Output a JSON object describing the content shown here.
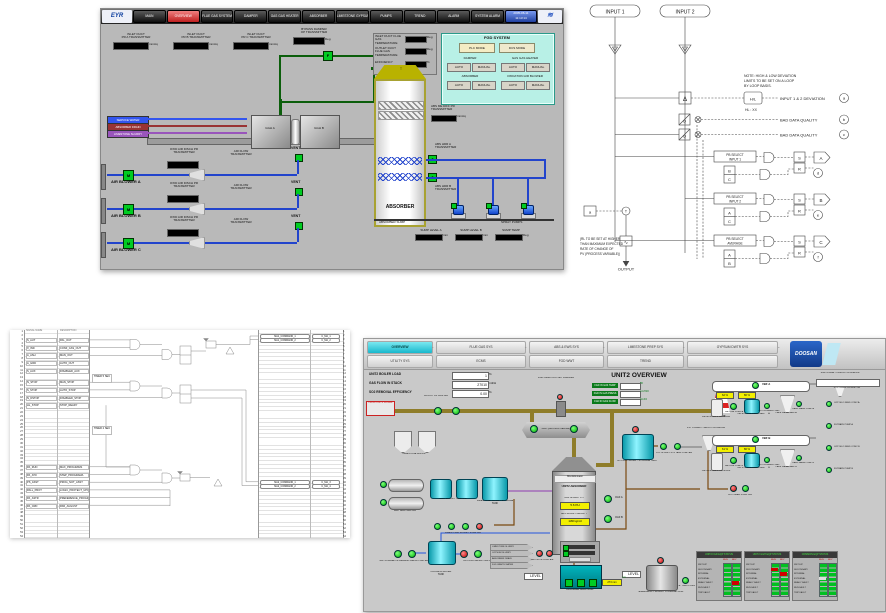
{
  "colors": {
    "active_tab": "#18b8cc",
    "pump_on": "#00b400",
    "pump_off": "#c00000",
    "value_yellow": "#f2ef00",
    "panel_cyan": "#b8f0e6",
    "pipe_blue": "#2244cc",
    "pipe_green": "#0b5e0b",
    "duct_olive": "#8f7d2a"
  },
  "panelA": {
    "nav": {
      "logo": "EYR",
      "buttons": [
        "MAIN",
        "OVERVIEW",
        "FLUE GAS SYSTEM",
        "DAMPER",
        "GAS GAS HEATER",
        "ABSORBER",
        "LIMESTONE GYPSUM",
        "PUMPS",
        "TREND",
        "ALARM",
        "SYSTEM ALARM"
      ],
      "clock1": "2005-06-11",
      "clock2": "11:13:14",
      "brand": "≋"
    },
    "inlet_metrics": [
      {
        "l1": "INLET DUCT",
        "l2": "PR A TRANSMITTER",
        "unit": "mmAq"
      },
      {
        "l1": "INLET DUCT",
        "l2": "PR B TRANSMITTER",
        "unit": "mmAq"
      },
      {
        "l1": "INLET DUCT",
        "l2": "PR C TRANSMITTER",
        "unit": "mmAq"
      }
    ],
    "bypass": {
      "l1": "BYPASS DAMPER",
      "l2": "OP TRANSMITTER",
      "unit": "Deg",
      "flag": "F"
    },
    "right_metrics": [
      {
        "l1": "INLET DUCT FLUE GAS",
        "l2": "TEMPERATURE",
        "unit": "Deg"
      },
      {
        "l1": "OUTLET DUCT FLUE GAS",
        "l2": "TEMPERATURE",
        "unit": "Deg"
      },
      {
        "l1": "EFFICIENCY",
        "l2": "",
        "unit": "%"
      }
    ],
    "fgd_panel": {
      "title": "FGD SYSTEM",
      "plc": "PLC MODE",
      "dcs": "DCS MODE",
      "groups": [
        {
          "t": "DAMPER",
          "a": "AUTO",
          "m": "MANUAL"
        },
        {
          "t": "GAS GAS HEATER",
          "a": "AUTO",
          "m": "MANUAL"
        },
        {
          "t": "ABSORBER",
          "a": "AUTO",
          "m": "MANUAL"
        },
        {
          "t": "OXIDATION AIR BLOWER",
          "a": "AUTO",
          "m": "MANUAL"
        }
      ]
    },
    "tags": [
      "SERVICE WATER",
      "ABSORBER DRAIN",
      "LIMESTONE SLURRY"
    ],
    "ggh": [
      "GGH A",
      "GGH B"
    ],
    "absorber": {
      "label": "ABSORBER",
      "arrow": "↑",
      "me_l1": "ABS ME DIFF PR",
      "me_l2": "TRANSMITTER",
      "me_unit": "mmAq",
      "hdr_a": "ABS HDR A TRANSMITTER",
      "hdr_b": "ABS HDR B TRANSMITTER",
      "valve": "X"
    },
    "blowers": [
      {
        "name": "AIR BLOWER A",
        "tx1": "OXID AIR DISCH PR",
        "tx2": "TRANSMITTER",
        "rx1": "AIR FLOW",
        "rx2": "TRANSMITTER",
        "vent": "VENT",
        "m": "M"
      },
      {
        "name": "AIR BLOWER B",
        "tx1": "OXID AIR DISCH PR",
        "tx2": "TRANSMITTER",
        "rx1": "AIR FLOW",
        "rx2": "TRANSMITTER",
        "vent": "VENT",
        "m": "M"
      },
      {
        "name": "AIR BLOWER C",
        "tx1": "OXID AIR DISCH PR",
        "tx2": "TRANSMITTER",
        "rx1": "AIR FLOW",
        "rx2": "TRANSMITTER",
        "vent": "VENT",
        "m": "M"
      }
    ],
    "sump": {
      "left": "ABSORBER SUMP",
      "right": "SPRAY PUMPS",
      "metrics": [
        {
          "l1": "SUMP LEVEL A",
          "unit": "mm"
        },
        {
          "l1": "SUMP LEVEL B",
          "unit": "mm"
        },
        {
          "l1": "SUMP TEMP",
          "unit": "Deg"
        }
      ]
    }
  },
  "panelB": {
    "inputs": [
      "INPUT 1",
      "INPUT 2"
    ],
    "tri": "T",
    "delta": "Δ",
    "hl_box": "H/L",
    "note": [
      "NOTE: HIGH & LOW DEVIATION",
      "LIMITS TO BE SET ON A LOOP",
      "BY LOOP BASIS."
    ],
    "hl": "HL : XX",
    "dev_label": "INPUT 1 & 2 DEVIATION",
    "dev_circle": "a",
    "qual": "Q",
    "badq1": "BAD DATA QUALITY",
    "badq1_c": "b",
    "badq2": "BAD DATA QUALITY",
    "badq2_c": "c",
    "sel": [
      {
        "b1": "PB SELECT",
        "b2": "INPUT 1",
        "p1": "B",
        "p2": "C",
        "s": "S",
        "r": "R",
        "out": "A",
        "fb": "d"
      },
      {
        "b1": "PB SELECT",
        "b2": "INPUT 2",
        "p1": "A",
        "p2": "C",
        "s": "S",
        "r": "R",
        "out": "B",
        "fb": "e"
      },
      {
        "b1": "PB SELECT",
        "b2": "AVERAGE",
        "p1": "A",
        "p2": "B",
        "s": "S",
        "r": "R",
        "out": "C",
        "fb": "f"
      }
    ],
    "note2": [
      "(RL TO BE SET AT HIGHER",
      "THAN MAXIMUM EXPECTED",
      "RATE OF CHANGE OF",
      "PV (PROCESS VARIABLE))"
    ],
    "in_box": "a",
    "transfer": "T",
    "rate": "∿",
    "output": "OUTPUT"
  },
  "panelC": {
    "headers": {
      "sig": "SIGNAL NAME",
      "desc": "DESCRIPTION"
    },
    "left_nums": "1\n2\n3\n4\n5\n6\n7\n8\n9\n10\n11\n12\n13\n14\n15\n16\n17\n18\n19\n20\n21\n22\n23\n24\n25\n26\n27\n28\n29\n30\n31\n32\n33\n34\n35\n36\n37\n38\n39\n40\n41\n42\n43\n44\n45\n46\n47\n48\n49\n50\n51\n52\n53\n54",
    "right_nums": "1\n2\n3\n4\n5\n6\n7\n8\n9\n10\n11\n12\n13\n14\n15\n16\n17\n18\n19\n20\n21\n22\n23\n24\n25\n26\n27\n28\n29\n30\n31\n32\n33\n34\n35\n36\n37\n38\n39\n40\n41\n42\n43\n44\n45\n46\n47\n48\n49\n50\n51\n52\n53\n54",
    "rows": [
      {
        "sig": "S_AUT",
        "desc": "PAL_OUT"
      },
      {
        "sig": "X_IND",
        "desc": "CONF_CAS_OUT"
      },
      {
        "sig": "A_ASH",
        "desc": "MAN_OUT"
      },
      {
        "sig": "A_GRD",
        "desc": "AUTO_OUT"
      },
      {
        "sig": "S_AUX",
        "desc": "DISABLED_AUX"
      },
      {
        "sig": "N_STOP",
        "desc": "MAN_STOP"
      },
      {
        "sig": "S_STOP",
        "desc": "AUTO_STOP"
      },
      {
        "sig": "N_DSTOP",
        "desc": "DISABLED_STOP"
      },
      {
        "sig": "HL_STOP",
        "desc": "STOP_READY"
      },
      {
        "sig": "PA_RUN",
        "desc": "MAX_PROGRAMS"
      },
      {
        "sig": "PA_ATO",
        "desc": "STEP_PROGRAMA"
      },
      {
        "sig": "PS_ASST",
        "desc": "PROG_NOT_ASST"
      },
      {
        "sig": "PALL_PROT",
        "desc": "LOGIC_PROTECT_UPGRADED"
      },
      {
        "sig": "PA_ASTR",
        "desc": "PREFERENCE_PROGRAMA"
      },
      {
        "sig": "PA_CRD",
        "desc": "PAR_AUGUST"
      }
    ],
    "timers": [
      {
        "l1": "TIMER",
        "l2": "5 SEC"
      },
      {
        "l1": "TIMER",
        "l2": "2 SEC"
      }
    ],
    "right_rows": [
      {
        "desc": "MA1_COMMAND_1",
        "sig": "C_MA_1"
      },
      {
        "desc": "MA1_COMMAND_2",
        "sig": "C_MA_2"
      },
      {
        "desc": "MA2_COMMAND_1",
        "sig": "C_MA_3"
      },
      {
        "desc": "MA2_COMMAND_2",
        "sig": "C_MA_4"
      }
    ]
  },
  "panelD": {
    "tabs1": [
      "OVERVIEW",
      "FLUE GAS SYS",
      "ABS & EWS SYS",
      "LIMESTONE PREP SYS",
      "GYPSUM DWTR SYS"
    ],
    "tabs2": [
      "UTILITY SYS",
      "ECMS",
      "FGD WWT",
      "TREND"
    ],
    "logo": "DOOSAN",
    "info": [
      {
        "label": "UNIT2 BOILER LOAD",
        "value": "1",
        "unit": "%"
      },
      {
        "label": "GAS FLOW IN STACK",
        "value": "27010",
        "unit": "m3/H"
      },
      {
        "label": "SO2 REMOVAL EFFICIENCY",
        "value": "0.00",
        "unit": "%"
      }
    ],
    "title": "UNIT2 OVERVIEW",
    "from_boiler": "FROM UNIT2 BOILER",
    "damper": "FGD INLET/OUTLET DAMPER",
    "buf": "BOOST UP FAN A/B",
    "gas_rows": [
      {
        "label": "FGD IN GAS TEMP",
        "unit": "℃"
      },
      {
        "label": "FGD IN GAS PRESS",
        "unit": "mmH2O"
      },
      {
        "label": "FGD IN GAS FLOW",
        "unit": "Nm3/h"
      }
    ],
    "stack": "STACK",
    "ggh": "GGH (GAS GAS HEATER)",
    "absorber": {
      "name": "UNIT2 ABSORBER",
      "mist": "Mist Eliminator",
      "ph_label": "ABS SLURRY PH",
      "ph_value": "5.6 PH",
      "de_label": "ABS SLURRY DENSITY",
      "de_value": "1180 kg/m3"
    },
    "oaf": [
      "OAF A",
      "OAF B"
    ],
    "gyp_tank": "GYPSUM SLURRY STORAGE TANK",
    "gyp_pump": "GYP SLURRY STG TANK PUMP A/B",
    "hydro": "1ST STAGE HYDROCYCLONE A/B",
    "hydro2": "2ND STAGE HYDROCYCLONE A/B",
    "mills": {
      "bin": "LIMESTONE BIN A/B",
      "mill": "WET BALL MILL A/B",
      "mst": "MILL SLURRY TANK A/B",
      "lst": "LIMESTONE SLURRY STORAGE TANK",
      "lsp": "LIMESTONE SLURRY PUMP A/B"
    },
    "pw": {
      "tank1": "PROCESS WATER",
      "tank2": "TANK",
      "me_pump": "MIST ELIMINATOR WASHING WATER PUMP A/B",
      "pw_pump": "PROCESS WATER PUMP A/B"
    },
    "arrows": [
      "LIMESTONE SLURRY",
      "GYPSUM SLURRY",
      "ABSORBER DRAIN",
      "FGD WASTE WATER"
    ],
    "wwt_pump": "WWT BSTR PUMP A/B",
    "sump": {
      "name": "ABSORBER AREA SUMP",
      "level_label": "LEVEL",
      "level_value": "273 mm"
    },
    "etank": {
      "name1": "EMERGENCY SLURRY",
      "name2": "STORAGE TANK",
      "pump": "E. TANK PUMP",
      "level": "LEVEL",
      "unit": "mm"
    },
    "vbf": {
      "a": {
        "name": "VBF A",
        "v1": "62 %",
        "v2": "80 %",
        "recv": "VBF A FILTRATE RECEIVER",
        "vac": "VACUUM PUMP A",
        "cwt": "VBF A CLOTH WASH TANK",
        "cwp": "CLOTH WASH PUMP A",
        "cakt": "CAKE WASH TANK A",
        "cakp": "CAKE WASH PUMP A"
      },
      "b": {
        "name": "VBF B",
        "v1": "61 %",
        "v2": "80 %",
        "recv": "VBF B FILTRATE RECEIVER",
        "vac": "VACUUM PUMP B",
        "cwt": "VBF B CLOTH WASH TANK",
        "cwp": "CLOTH WASH PUMP B",
        "cakt": "CAKE WASH TANK B",
        "cakp": "CAKE WASH PUMP B"
      },
      "feed": "GYP FEED PUMP A/B",
      "conv": "GYP CAKE CONVEYOR"
    },
    "right_col": [
      "GYP SILO FEED CONV A",
      "FILTRATE PUMP A",
      "GYP SILO FEED CONV B",
      "FILTRATE PUMP B"
    ],
    "status_tables": [
      "UNIT2 FGD EQP STATUS",
      "UNIT2 GGH EQP STATUS",
      "COMMON EQP STATUS"
    ],
    "status_cols": [
      "RUN",
      "RDY"
    ],
    "status_rows_text": "WET E/P\nSECONDARY\nINTERNAL\nEXTERNAL\nREADY FAULT\nRUN FAULT\nTRIP FAULT"
  }
}
